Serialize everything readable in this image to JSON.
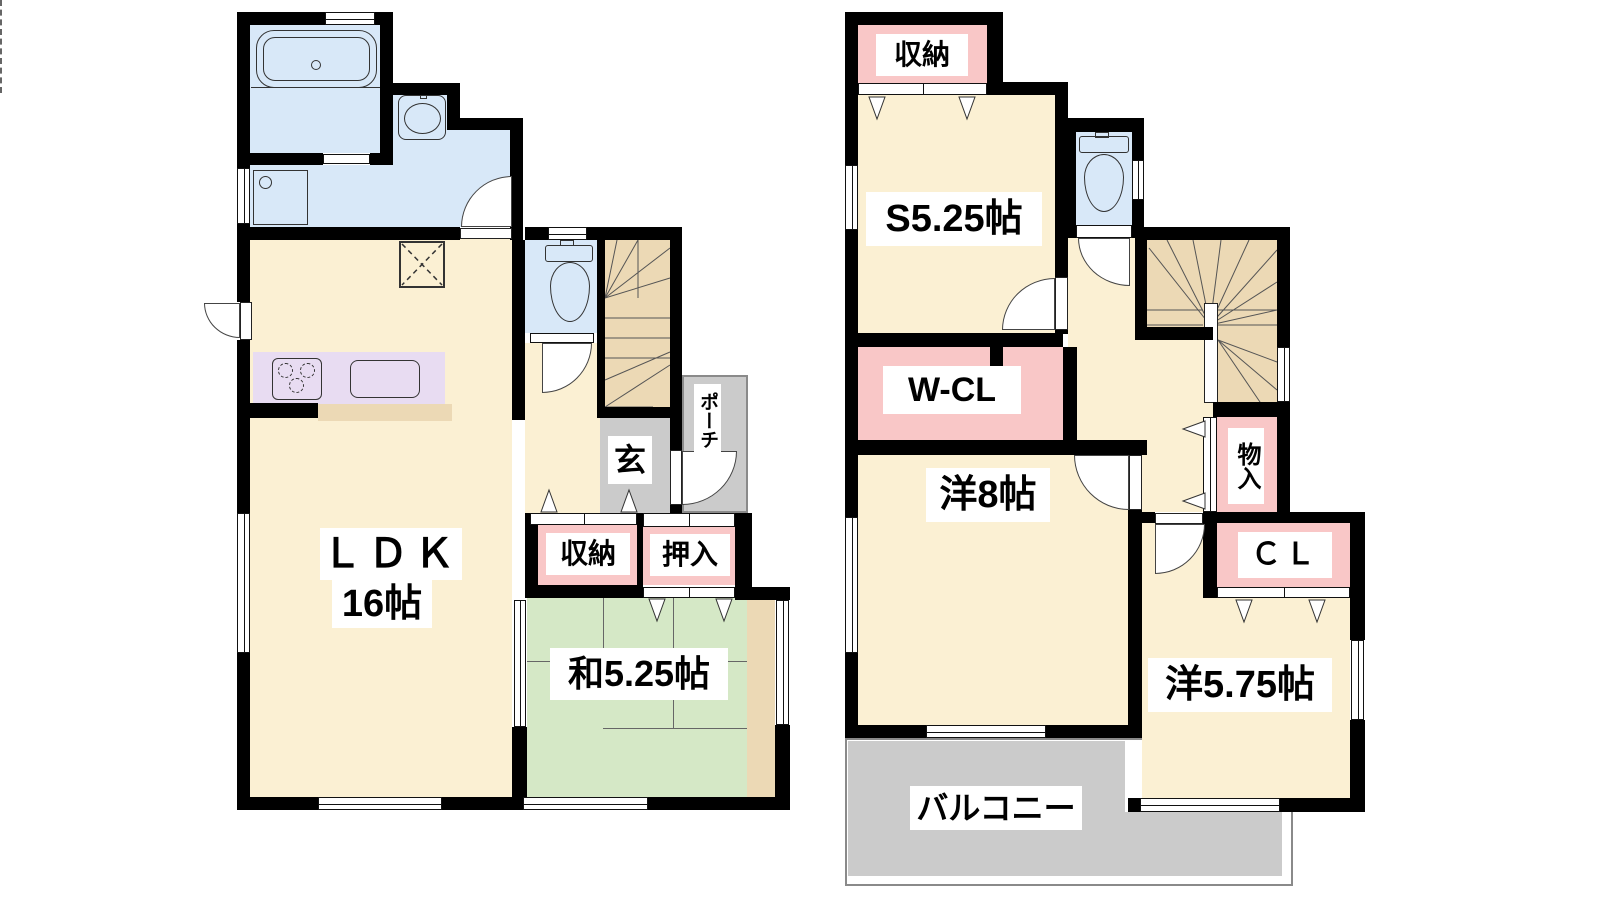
{
  "palette": {
    "wall": "#000000",
    "line": "#333333",
    "cream": "#fbf0d3",
    "green": "#d5e8c6",
    "pink": "#f9c7c7",
    "blue": "#d8e8f8",
    "lavender": "#e8dcf2",
    "tan": "#ecd9b5",
    "gray": "#cbcbcb",
    "label_bg": "#ffffff",
    "text": "#000000"
  },
  "floor1": {
    "ldk": "ＬＤＫ",
    "ldk_size": "16帖",
    "washitsu": "和5.25帖",
    "shunou": "収納",
    "oshiire": "押入",
    "genkan": "玄",
    "porch": "ポーチ"
  },
  "floor2": {
    "shunou": "収納",
    "service_room": "S5.25帖",
    "wcl": "W-CL",
    "west8": "洋8帖",
    "mononyu": "物入",
    "cl": "ＣＬ",
    "west575": "洋5.75帖",
    "balcony": "バルコニー"
  }
}
